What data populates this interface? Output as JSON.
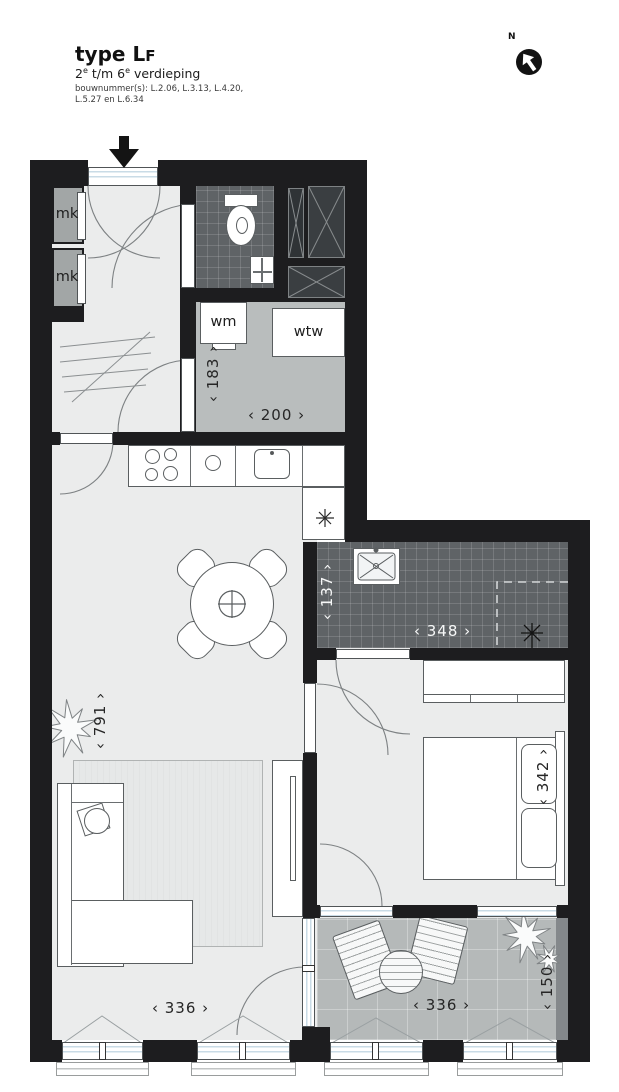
{
  "header": {
    "title_main": "type L",
    "title_small": "F",
    "subtitle_pre": "2",
    "subtitle_sup1": "e",
    "subtitle_mid": " t/m 6",
    "subtitle_sup2": "e",
    "subtitle_post": " verdieping",
    "bouwnummers_line1": "bouwnummer(s): L.2.06, L.3.13, L.4.20,",
    "bouwnummers_line2": "L.5.27 en L.6.34"
  },
  "compass": {
    "north_label": "N"
  },
  "room_labels": {
    "meter_cupboard_1": "mk",
    "meter_cupboard_2": "mk",
    "washing_machine": "wm",
    "heat_recovery": "wtw"
  },
  "dimensions": {
    "utility_depth": "‹ 183 ›",
    "utility_width": "‹ 200 ›",
    "bathroom_depth": "‹ 137 ›",
    "bathroom_width": "‹ 348 ›",
    "living_depth": "‹ 791 ›",
    "bedroom_depth": "‹ 342 ›",
    "living_width": "‹ 336 ›",
    "balcony_width": "‹ 336 ›",
    "balcony_depth": "‹ 150 ›"
  },
  "colors": {
    "wall": "#1d1d1f",
    "floor_light": "#ebecec",
    "floor_utility": "#b9bdbd",
    "floor_tile": "#5f6366",
    "floor_balcony": "#b5b9b9",
    "shaft": "#3a3e41",
    "closet": "#a2a6a6",
    "accent_glass": "#c9dbe6"
  }
}
